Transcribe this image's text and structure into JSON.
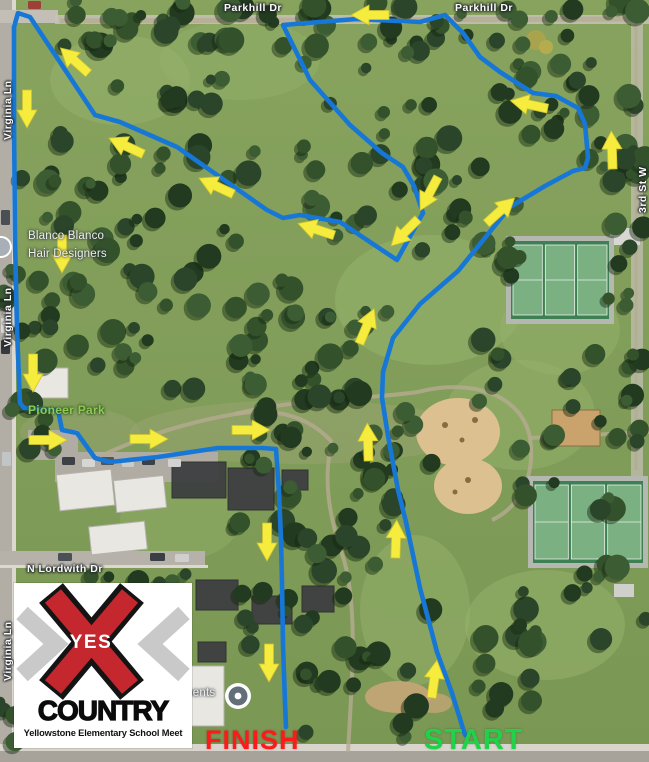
{
  "map": {
    "labels": [
      {
        "text": "Parkhill Dr",
        "x": 224,
        "y": 2,
        "cls": "street",
        "name": "street-label-parkhill-1"
      },
      {
        "text": "Parkhill Dr",
        "x": 455,
        "y": 2,
        "cls": "street",
        "name": "street-label-parkhill-2"
      },
      {
        "text": "Virginia Ln",
        "x": 2,
        "y": 140,
        "cls": "street vert",
        "name": "street-label-virginia-1"
      },
      {
        "text": "Virginia Ln",
        "x": 2,
        "y": 347,
        "cls": "street vert",
        "name": "street-label-virginia-2"
      },
      {
        "text": "Virginia Ln",
        "x": 2,
        "y": 681,
        "cls": "street vert",
        "name": "street-label-virginia-3"
      },
      {
        "text": "N Lordwith Dr",
        "x": 27,
        "y": 563,
        "cls": "street",
        "name": "street-label-lordwith"
      },
      {
        "text": "3rd St W",
        "x": 637,
        "y": 213,
        "cls": "street vert",
        "name": "street-label-3rd-st"
      },
      {
        "text": "Blanco Blanco",
        "x": 28,
        "y": 230,
        "cls": "poi",
        "name": "poi-label-blanco-line1"
      },
      {
        "text": "Hair Designers",
        "x": 28,
        "y": 248,
        "cls": "poi",
        "name": "poi-label-blanco-line2"
      },
      {
        "text": "ments",
        "x": 183,
        "y": 687,
        "cls": "poi",
        "name": "poi-label-ments"
      },
      {
        "text": "Pioneer Park",
        "x": 28,
        "y": 403,
        "cls": "park",
        "name": "park-label-pioneer"
      }
    ]
  },
  "course": {
    "route_color": "#1777d6",
    "arrow_color": "#f6ec3d",
    "arrow_edge_color": "#cfc32f",
    "route": [
      [
        465,
        735
      ],
      [
        452,
        693
      ],
      [
        437,
        652
      ],
      [
        420,
        588
      ],
      [
        406,
        522
      ],
      [
        398,
        490
      ],
      [
        388,
        436
      ],
      [
        382,
        398
      ],
      [
        383,
        372
      ],
      [
        393,
        338
      ],
      [
        420,
        304
      ],
      [
        458,
        271
      ],
      [
        510,
        207
      ],
      [
        545,
        186
      ],
      [
        573,
        171
      ],
      [
        585,
        168
      ],
      [
        588,
        158
      ],
      [
        585,
        124
      ],
      [
        578,
        108
      ],
      [
        556,
        96
      ],
      [
        533,
        93
      ],
      [
        500,
        72
      ],
      [
        480,
        57
      ],
      [
        463,
        33
      ],
      [
        445,
        15
      ],
      [
        420,
        22
      ],
      [
        356,
        19
      ],
      [
        283,
        25
      ],
      [
        310,
        80
      ],
      [
        350,
        125
      ],
      [
        382,
        153
      ],
      [
        403,
        167
      ],
      [
        414,
        186
      ],
      [
        423,
        213
      ],
      [
        397,
        260
      ],
      [
        340,
        222
      ],
      [
        300,
        215
      ],
      [
        283,
        218
      ],
      [
        267,
        210
      ],
      [
        177,
        147
      ],
      [
        120,
        122
      ],
      [
        95,
        115
      ],
      [
        30,
        17
      ],
      [
        18,
        13
      ],
      [
        14,
        27
      ],
      [
        14,
        120
      ],
      [
        15,
        240
      ],
      [
        17,
        330
      ],
      [
        20,
        403
      ],
      [
        24,
        408
      ],
      [
        58,
        410
      ],
      [
        62,
        430
      ],
      [
        77,
        433
      ],
      [
        95,
        458
      ],
      [
        110,
        462
      ],
      [
        158,
        457
      ],
      [
        218,
        448
      ],
      [
        262,
        448
      ],
      [
        276,
        449
      ],
      [
        279,
        492
      ],
      [
        281,
        540
      ],
      [
        282,
        582
      ],
      [
        283,
        645
      ],
      [
        285,
        703
      ],
      [
        286,
        727
      ]
    ],
    "arrows": [
      [
        372,
        15,
        180
      ],
      [
        76,
        62,
        222
      ],
      [
        27,
        107,
        90
      ],
      [
        62,
        252,
        90
      ],
      [
        33,
        371,
        90
      ],
      [
        46,
        440,
        0
      ],
      [
        147,
        439,
        0
      ],
      [
        249,
        430,
        0
      ],
      [
        267,
        540,
        90
      ],
      [
        269,
        661,
        90
      ],
      [
        434,
        681,
        278
      ],
      [
        396,
        541,
        272
      ],
      [
        368,
        444,
        268
      ],
      [
        366,
        328,
        293
      ],
      [
        499,
        212,
        318
      ],
      [
        612,
        152,
        268
      ],
      [
        531,
        105,
        192
      ],
      [
        430,
        192,
        118
      ],
      [
        406,
        231,
        135
      ],
      [
        128,
        147,
        205
      ],
      [
        218,
        187,
        205
      ],
      [
        318,
        230,
        198
      ]
    ],
    "start_label": {
      "text": "START",
      "x": 424,
      "y": 724,
      "color": "#1fd24a",
      "size": 29
    },
    "finish_label": {
      "text": "FINISH",
      "x": 205,
      "y": 725,
      "color": "#fe1a1a",
      "size": 27
    },
    "pin": {
      "x": 238,
      "y": 696
    }
  },
  "logo": {
    "yes": "YES",
    "country": "COUNTRY",
    "subtitle": "Yellowstone Elementary School Meet",
    "x_color": "#c4272e",
    "x_outline_color": "#141414",
    "chevron_color": "#c9c9c9"
  }
}
